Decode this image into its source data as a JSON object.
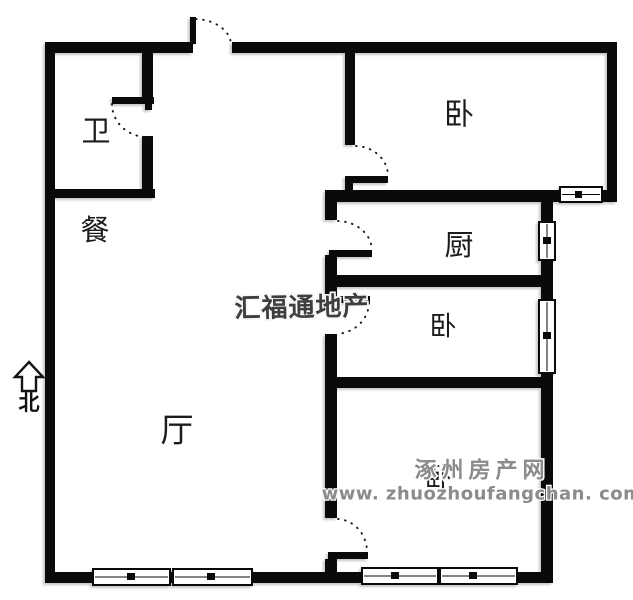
{
  "plan": {
    "rooms": {
      "bathroom": "卫",
      "dining": "餐",
      "living": "厅",
      "bedroom_top": "卧",
      "kitchen": "厨",
      "bedroom_middle": "卧",
      "bedroom_bottom": "卧"
    },
    "compass_north": "北"
  },
  "watermarks": {
    "brand_center": "汇福通地产",
    "site_name": "涿州房产网",
    "site_url": "www. zhuozhoufangchan. com"
  },
  "colors": {
    "background": "#ffffff",
    "wall": "#0a0a0a",
    "brand_watermark": "#3e3e3e",
    "site_watermark": "#8b8b8b"
  }
}
